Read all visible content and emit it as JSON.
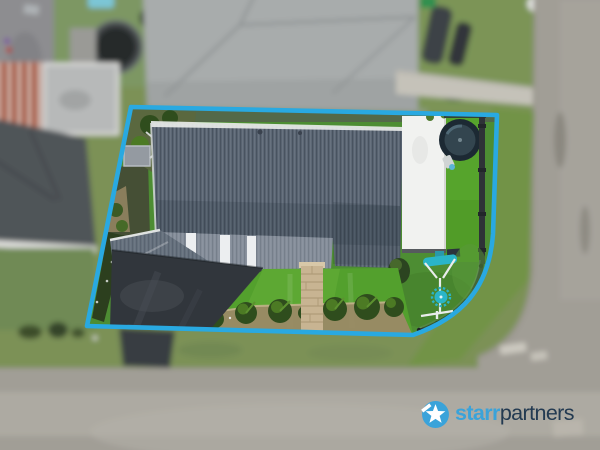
{
  "image": {
    "type": "aerial-property-photo",
    "description": "Overhead drone photograph of a single-storey home outlined with a blue property boundary; surroundings are blurred. Real-estate agency watermark bottom right."
  },
  "branding": {
    "logo_icon": "star-circle-icon",
    "logo_text_primary": "starr",
    "logo_text_secondary": "partners"
  },
  "palette": {
    "boundary-line": "#29a9e1",
    "roof-main": "#5c6775",
    "roof-front": "#87909c",
    "roof-garage": "#67727f",
    "roof-white": "#f1f2f0",
    "driveway": "#31363c",
    "lawn-front": "#53a02d",
    "lawn-back": "#4d8d33",
    "turf": "#56a42c",
    "garden-soil": "#9b8a66",
    "plant-dark": "#2f4d1d",
    "plant-mid": "#4c7a24",
    "hedge": "#2c3f1e",
    "fence": "#2e3237",
    "play-teal": "#2ab5c8",
    "pool-rim": "#1c2933",
    "pool-water": "#33454f",
    "neighbor-roof-light": "#a8acac",
    "neighbor-roof-dark": "#4f5458",
    "neighbor-roof-terra": "#a85a42",
    "grass-outside": "#7c9157",
    "road": "#a19e96",
    "road-light": "#b2aea5",
    "concrete-path": "#c5c2b9",
    "neighbor-pool": "#282b2c",
    "pavers": "#c8b492",
    "paver-line": "#b09c78",
    "logo-primary": "#3aa3da",
    "logo-secondary": "#233a51"
  },
  "scene": {
    "subject_property_features": [
      "corrugated-metal-roof",
      "white-flat-roof",
      "above-ground-pool",
      "synthetic-turf-strip",
      "swing-set",
      "paver-path",
      "asphalt-driveway",
      "hedge-row",
      "tropical-garden-bed",
      "front-lawn",
      "dark-fence"
    ],
    "surroundings_features": [
      "neighbor-hipped-roofs",
      "neighbor-round-pool",
      "street",
      "footpath",
      "nature-strip",
      "parked-white-car",
      "boat-trailer",
      "wheelie-bins"
    ]
  }
}
